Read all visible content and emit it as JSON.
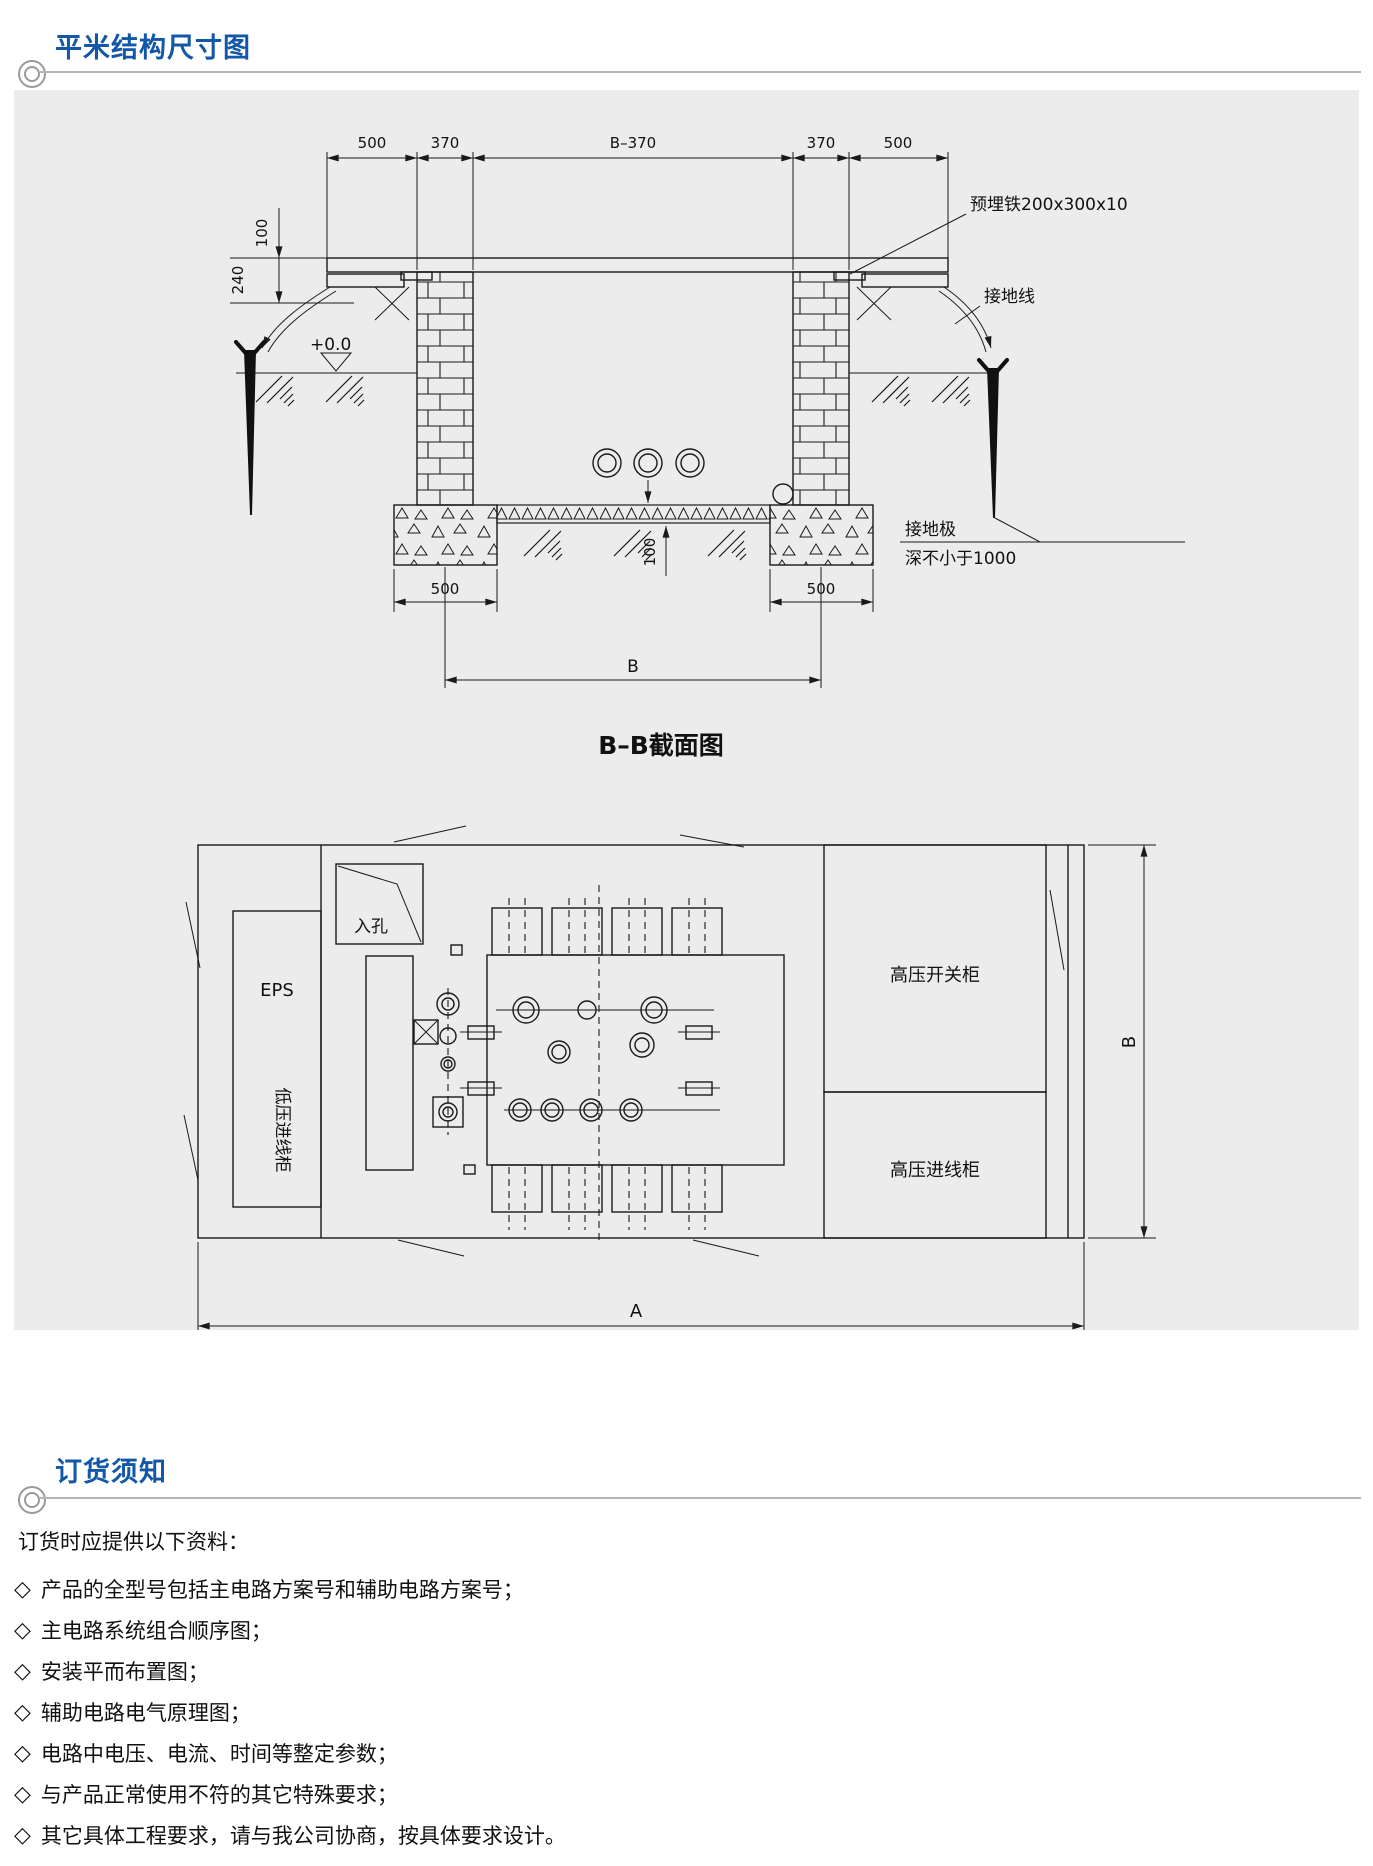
{
  "page": {
    "accent_blue": "#1257a8",
    "panel_bg": "#ececec",
    "line_gray": "#b5b5b5",
    "ink": "#1a1a1a"
  },
  "section1": {
    "title": "平米结构尺寸图"
  },
  "section2": {
    "title": "订货须知"
  },
  "cross_section": {
    "caption": "B–B截面图",
    "dims_top": [
      "500",
      "370",
      "B–370",
      "370",
      "500"
    ],
    "dim_100_top": "100",
    "dim_240": "240",
    "level_mark": "+0.0",
    "label_embedded_iron": "预埋铁200x300x10",
    "label_ground_wire": "接地线",
    "dim_100_bottom": "100",
    "dim_500_left": "500",
    "dim_500_right": "500",
    "dim_B": "B",
    "label_ground_rod_line1": "接地极",
    "label_ground_rod_line2": "深不小于1000"
  },
  "plan_view": {
    "label_manhole": "入孔",
    "label_eps": "EPS",
    "label_lv_incoming": "低压进线柜",
    "label_hv_switch": "高压开关柜",
    "label_hv_incoming": "高压进线柜",
    "dim_A": "A",
    "dim_B": "B"
  },
  "notes": {
    "intro": "订货时应提供以下资料：",
    "bullet": "◇",
    "items": [
      "产品的全型号包括主电路方案号和辅助电路方案号；",
      "主电路系统组合顺序图；",
      "安装平而布置图；",
      "辅助电路电气原理图；",
      "电路中电压、电流、时间等整定参数；",
      "与产品正常使用不符的其它特殊要求；",
      "其它具体工程要求，请与我公司协商，按具体要求设计。"
    ]
  }
}
